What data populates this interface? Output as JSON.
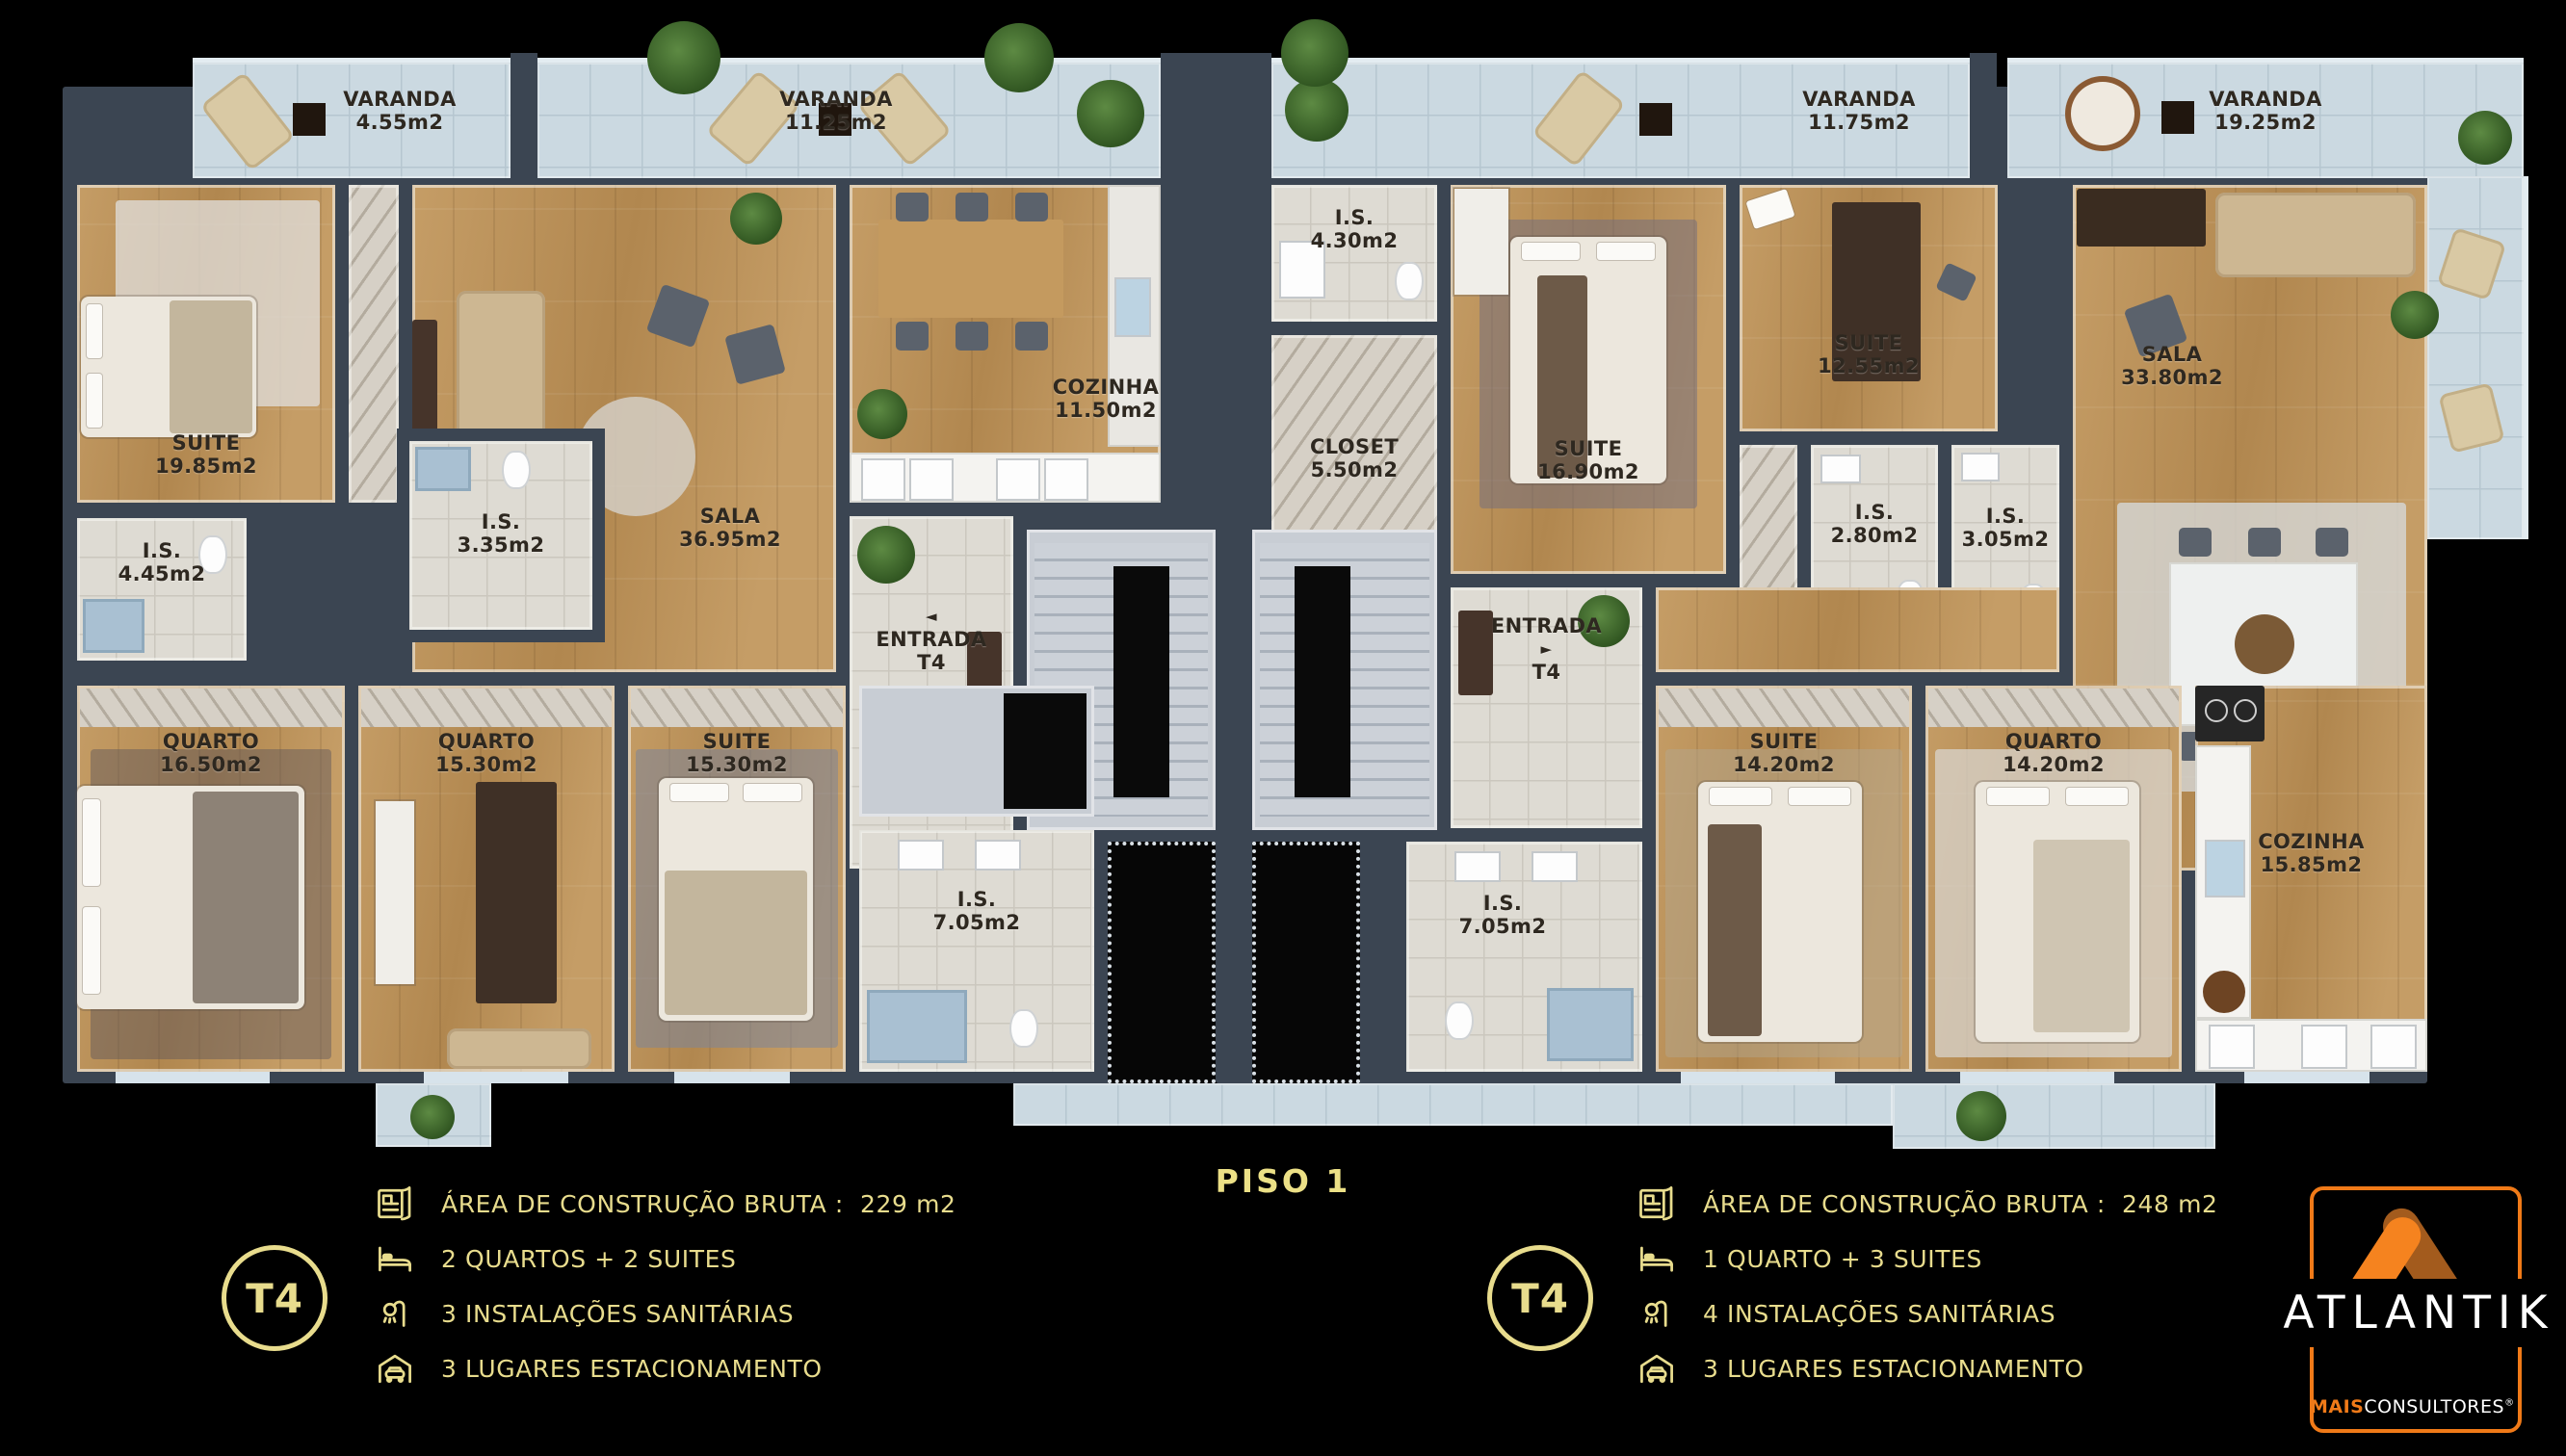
{
  "title": {
    "floor_label": "PISO 1"
  },
  "plan": {
    "balconies": {
      "b1": {
        "name": "VARANDA",
        "area": "4.55m2"
      },
      "b2": {
        "name": "VARANDA",
        "area": "11.25m2"
      },
      "b3": {
        "name": "VARANDA",
        "area": "11.75m2"
      },
      "b4": {
        "name": "VARANDA",
        "area": "19.25m2"
      }
    },
    "left": {
      "suite1": {
        "name": "SUITE",
        "area": "19.85m2"
      },
      "is1": {
        "name": "I.S.",
        "area": "4.45m2"
      },
      "is2": {
        "name": "I.S.",
        "area": "3.35m2"
      },
      "sala": {
        "name": "SALA",
        "area": "36.95m2"
      },
      "cozinha": {
        "name": "COZINHA",
        "area": "11.50m2"
      },
      "entrada": {
        "name": "ENTRADA",
        "area": "T4",
        "arrow": "◄"
      },
      "quarto1": {
        "name": "QUARTO",
        "area": "16.50m2"
      },
      "quarto2": {
        "name": "QUARTO",
        "area": "15.30m2"
      },
      "suite2": {
        "name": "SUITE",
        "area": "15.30m2"
      },
      "is3": {
        "name": "I.S.",
        "area": "7.05m2"
      }
    },
    "right": {
      "is1": {
        "name": "I.S.",
        "area": "4.30m2"
      },
      "closet": {
        "name": "CLOSET",
        "area": "5.50m2"
      },
      "suite1": {
        "name": "SUITE",
        "area": "16.90m2"
      },
      "suite2": {
        "name": "SUITE",
        "area": "12.55m2"
      },
      "is2": {
        "name": "I.S.",
        "area": "2.80m2"
      },
      "is3": {
        "name": "I.S.",
        "area": "3.05m2"
      },
      "sala": {
        "name": "SALA",
        "area": "33.80m2"
      },
      "entrada": {
        "name": "ENTRADA",
        "area": "T4",
        "arrow": "►"
      },
      "suite3": {
        "name": "SUITE",
        "area": "14.20m2"
      },
      "quarto": {
        "name": "QUARTO",
        "area": "14.20m2"
      },
      "cozinha": {
        "name": "COZINHA",
        "area": "15.85m2"
      },
      "is4": {
        "name": "I.S.",
        "area": "7.05m2"
      }
    }
  },
  "legend_left": {
    "unit": "T4",
    "rows": [
      {
        "icon": "blueprint-icon",
        "text": "ÁREA DE CONSTRUÇÃO BRUTA :  229 m2"
      },
      {
        "icon": "bed-icon",
        "text": "2 QUARTOS + 2 SUITES"
      },
      {
        "icon": "shower-icon",
        "text": "3 INSTALAÇÕES SANITÁRIAS"
      },
      {
        "icon": "garage-icon",
        "text": "3 LUGARES ESTACIONAMENTO"
      }
    ]
  },
  "legend_right": {
    "unit": "T4",
    "rows": [
      {
        "icon": "blueprint-icon",
        "text": "ÁREA DE CONSTRUÇÃO BRUTA :  248 m2"
      },
      {
        "icon": "bed-icon",
        "text": "1 QUARTO + 3 SUITES"
      },
      {
        "icon": "shower-icon",
        "text": "4 INSTALAÇÕES SANITÁRIAS"
      },
      {
        "icon": "garage-icon",
        "text": "3 LUGARES ESTACIONAMENTO"
      }
    ]
  },
  "branding": {
    "wordmark": "ATLANTIK",
    "tagline_bold": "MAIS",
    "tagline": "CONSULTORES",
    "registered": "®"
  },
  "colors": {
    "accent_gold": "#e8dc8d",
    "logo_orange": "#f5831f",
    "logo_dark_orange": "#a35b1d",
    "wall": "#3b4552"
  }
}
